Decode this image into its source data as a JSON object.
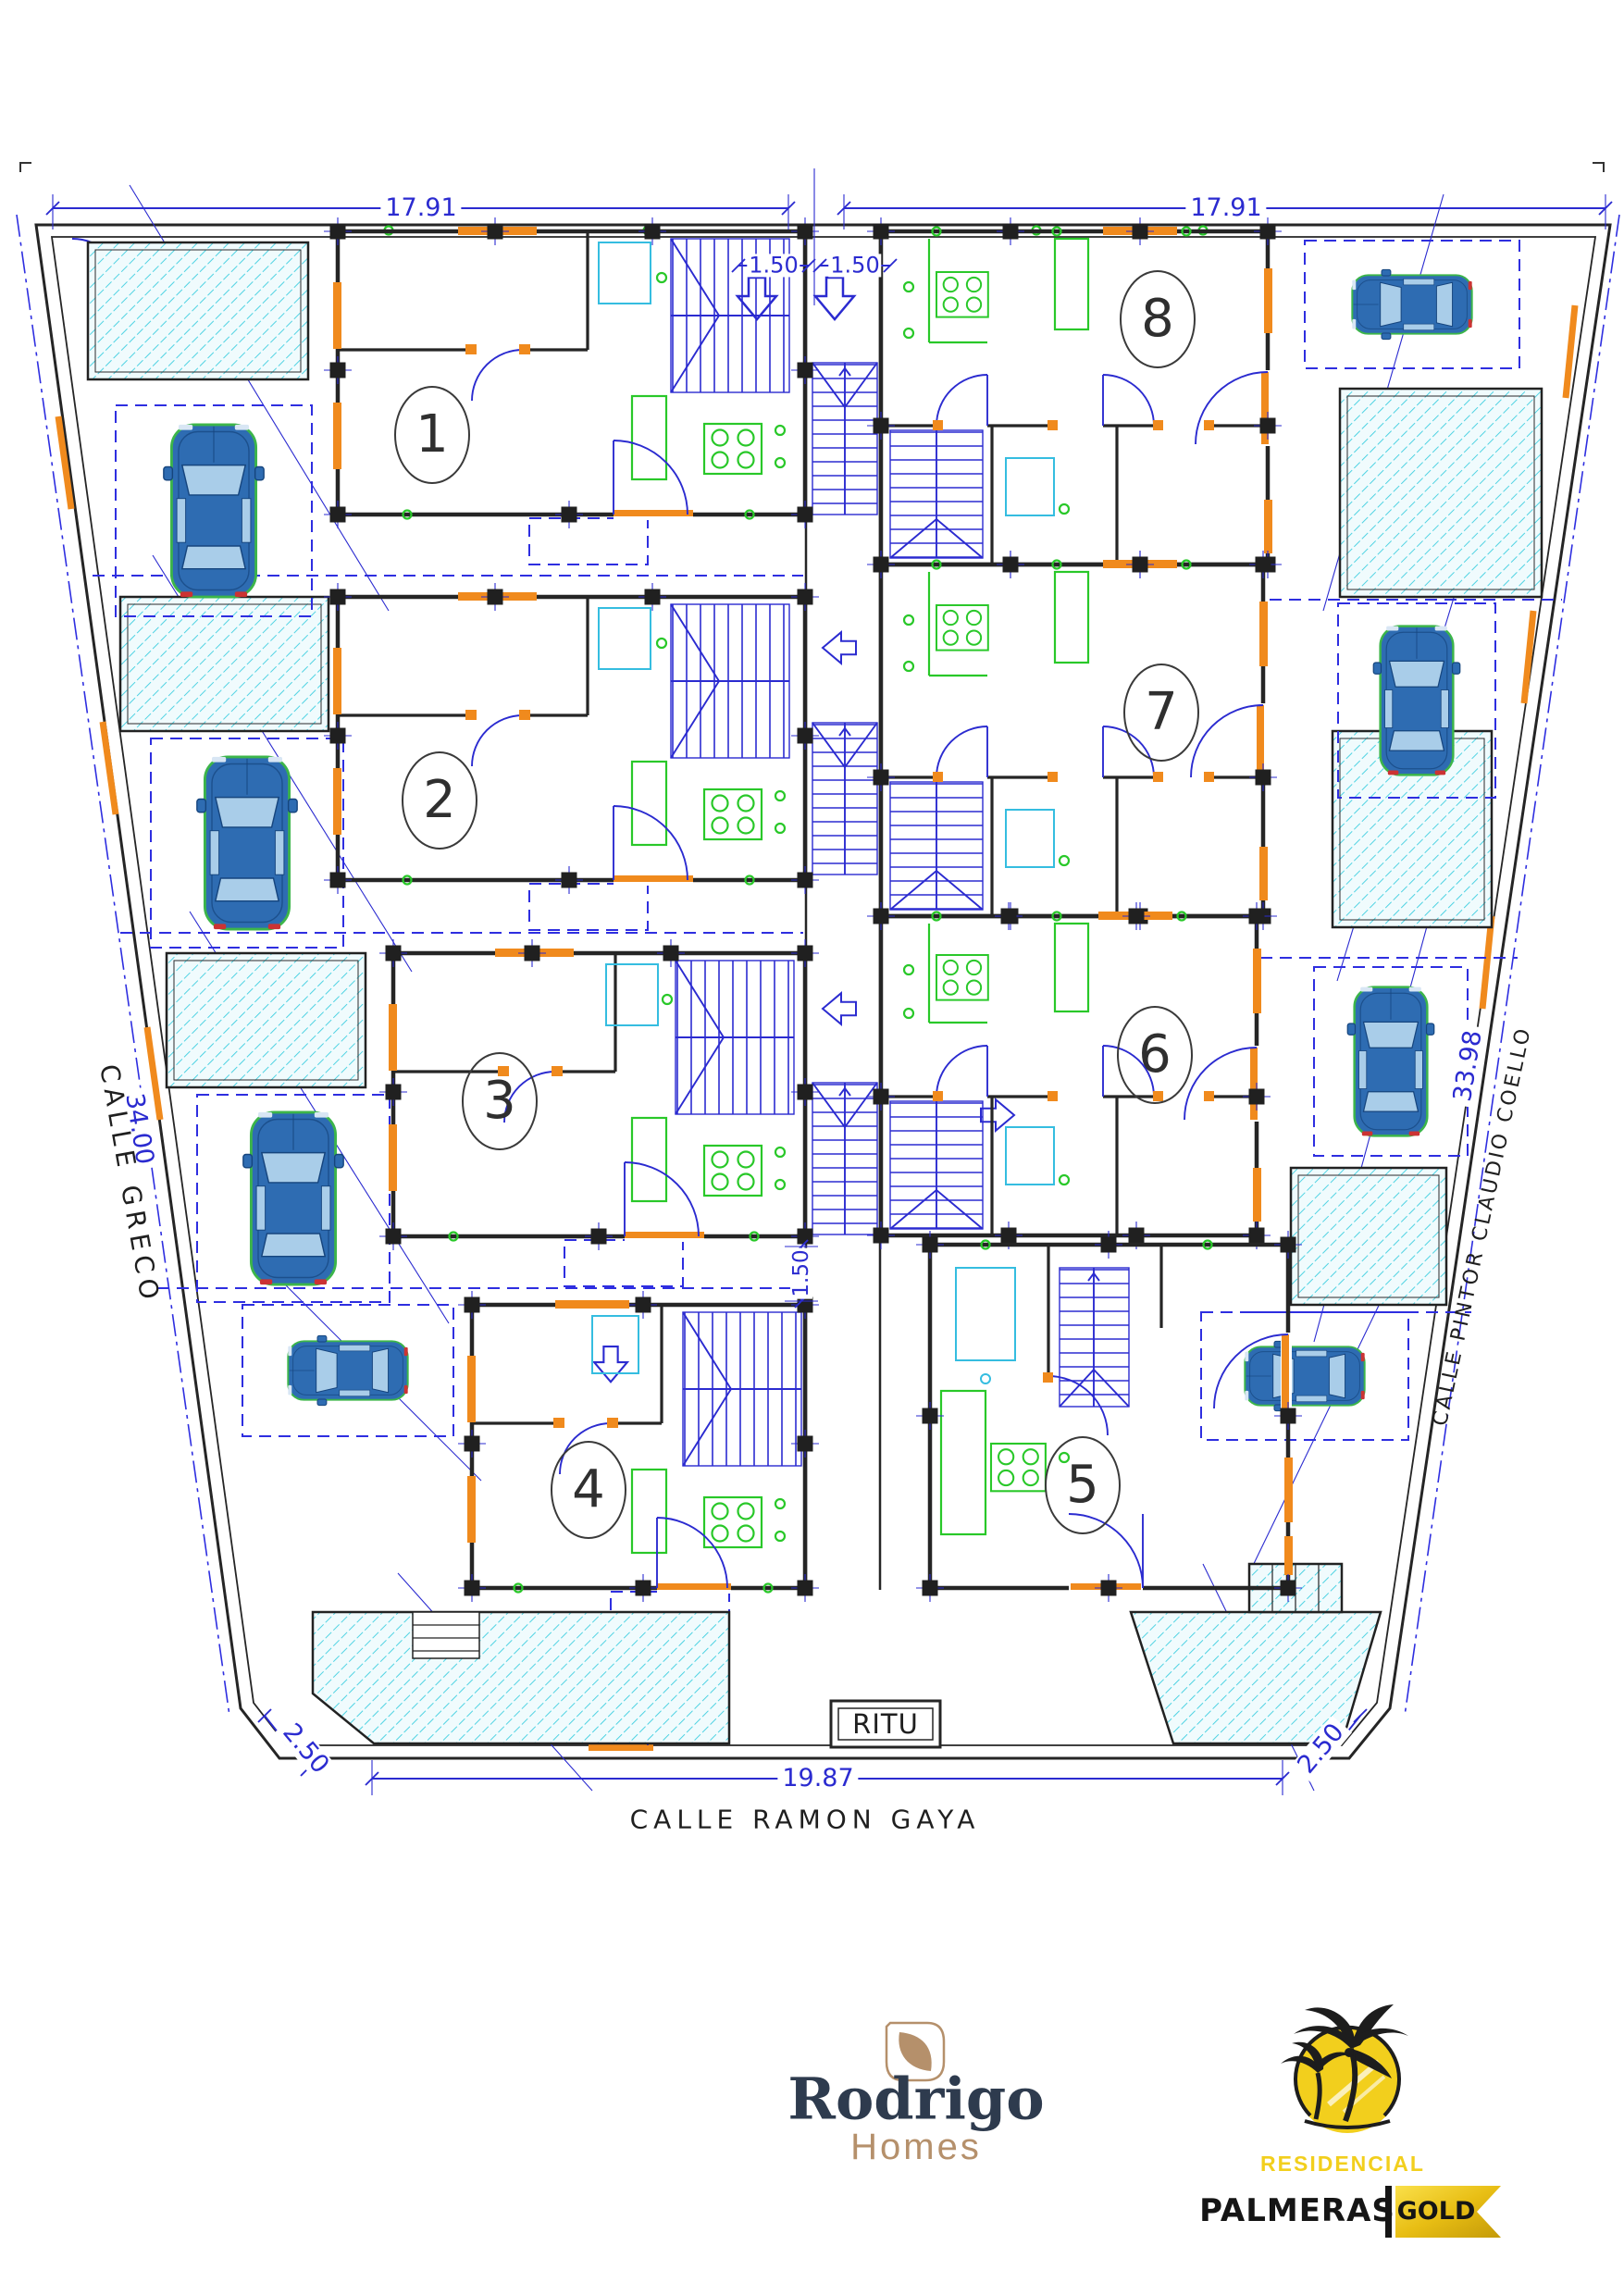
{
  "plan": {
    "dimensions": {
      "top_left_width": "17.91",
      "top_right_width": "17.91",
      "top_gap_left": "1.50",
      "top_gap_right": "1.50",
      "left_depth": "34.00",
      "right_depth": "33.98",
      "mid_gap": "1.50",
      "bottom_width": "19.87",
      "bottom_left_chamfer": "2.50",
      "bottom_right_chamfer": "2.50"
    },
    "streets": {
      "left": "CALLE GRECO",
      "right": "CALLE PINTOR CLAUDIO COELLO",
      "bottom": "CALLE RAMON GAYA"
    },
    "rooms": {
      "ritu": "RITU"
    },
    "units": [
      {
        "number": "1"
      },
      {
        "number": "2"
      },
      {
        "number": "3"
      },
      {
        "number": "4"
      },
      {
        "number": "5"
      },
      {
        "number": "6"
      },
      {
        "number": "7"
      },
      {
        "number": "8"
      }
    ]
  },
  "branding": {
    "rodrigo": {
      "icon": "leaf-icon",
      "name": "Rodrigo",
      "subtitle": "Homes"
    },
    "palmeras": {
      "icon": "palm-sun-icon",
      "line1": "RESIDENCIAL",
      "line2": "PALMERAS",
      "badge": "GOLD"
    }
  },
  "colors": {
    "dimension_blue": "#2b2bd0",
    "wall_black": "#252525",
    "joinery_orange": "#f08a1d",
    "kitchen_green": "#29c829",
    "pool_cyan": "#3ecfe0",
    "car_blue": "#2e6cb2",
    "brand_navy": "#2e3b4e",
    "brand_tan": "#b5906b",
    "brand_yellow": "#f2cf1d"
  }
}
